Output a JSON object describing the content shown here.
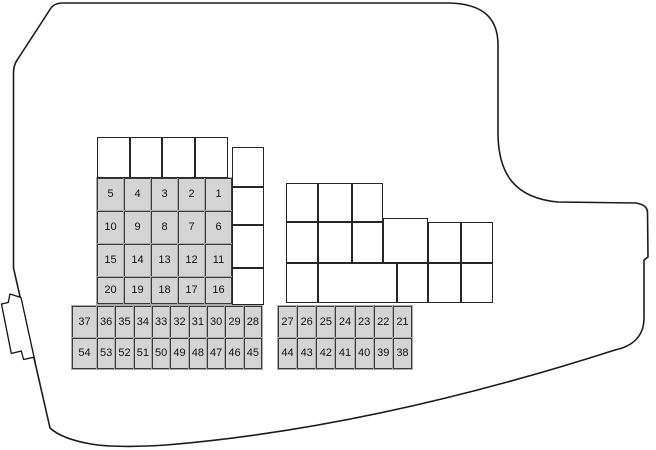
{
  "colors": {
    "background": "#ffffff",
    "outline_line": "#1b1b1b",
    "fuse_fill": "#d4d4d4",
    "fuse_border": "#3a3a3a",
    "empty_cell_fill": "#ffffff",
    "empty_cell_border": "#262626"
  },
  "numbered_blocks": [
    {
      "name": "left-fuse-grid",
      "col_edges": [
        97,
        124,
        151,
        178,
        205,
        232
      ],
      "row_edges": [
        178,
        211,
        244,
        277,
        304
      ],
      "rows": [
        [
          "5",
          "4",
          "3",
          "2",
          "1"
        ],
        [
          "10",
          "9",
          "8",
          "7",
          "6"
        ],
        [
          "15",
          "14",
          "13",
          "12",
          "11"
        ],
        [
          "20",
          "19",
          "18",
          "17",
          "16"
        ]
      ]
    },
    {
      "name": "left-bottom-fuse-rows",
      "col_edges": [
        72,
        97,
        115.3,
        133.7,
        152,
        170.3,
        188.7,
        207,
        225.3,
        243.7,
        262
      ],
      "row_edges": [
        306,
        338,
        369
      ],
      "rows": [
        [
          "37",
          "36",
          "35",
          "34",
          "33",
          "32",
          "31",
          "30",
          "29",
          "28"
        ],
        [
          "54",
          "53",
          "52",
          "51",
          "50",
          "49",
          "48",
          "47",
          "46",
          "45"
        ]
      ]
    },
    {
      "name": "right-bottom-fuse-rows",
      "col_edges": [
        278,
        297.1,
        316.3,
        335.4,
        354.6,
        373.7,
        392.9,
        412
      ],
      "row_edges": [
        306,
        338,
        369
      ],
      "rows": [
        [
          "27",
          "26",
          "25",
          "24",
          "23",
          "22",
          "21"
        ],
        [
          "44",
          "43",
          "42",
          "41",
          "40",
          "39",
          "38"
        ]
      ]
    }
  ],
  "empty_blocks": [
    {
      "name": "left-top-empty-row",
      "cells": [
        [
          97,
          137,
          32.5,
          41
        ],
        [
          129.5,
          137,
          32.5,
          41
        ],
        [
          162,
          137,
          32.5,
          41
        ],
        [
          194.5,
          137,
          33,
          41
        ]
      ]
    },
    {
      "name": "left-side-empty-column",
      "cells": [
        [
          232,
          147,
          32,
          40
        ],
        [
          232,
          187,
          32,
          38
        ],
        [
          232,
          225,
          32,
          43
        ],
        [
          232,
          268,
          32,
          37
        ]
      ]
    },
    {
      "name": "right-empty-block",
      "cells": [
        [
          286,
          183,
          32,
          39
        ],
        [
          318,
          183,
          34,
          39
        ],
        [
          352,
          183,
          31,
          39
        ],
        [
          286,
          222,
          32,
          41
        ],
        [
          318,
          222,
          34,
          41
        ],
        [
          352,
          222,
          31,
          41
        ],
        [
          383,
          218,
          45,
          45
        ],
        [
          428,
          222,
          33,
          41
        ],
        [
          461,
          222,
          32,
          41
        ],
        [
          286,
          263,
          32,
          40
        ],
        [
          318,
          263,
          79,
          40
        ],
        [
          397,
          263,
          31,
          40
        ],
        [
          428,
          263,
          33,
          40
        ],
        [
          461,
          263,
          32,
          40
        ]
      ]
    }
  ]
}
